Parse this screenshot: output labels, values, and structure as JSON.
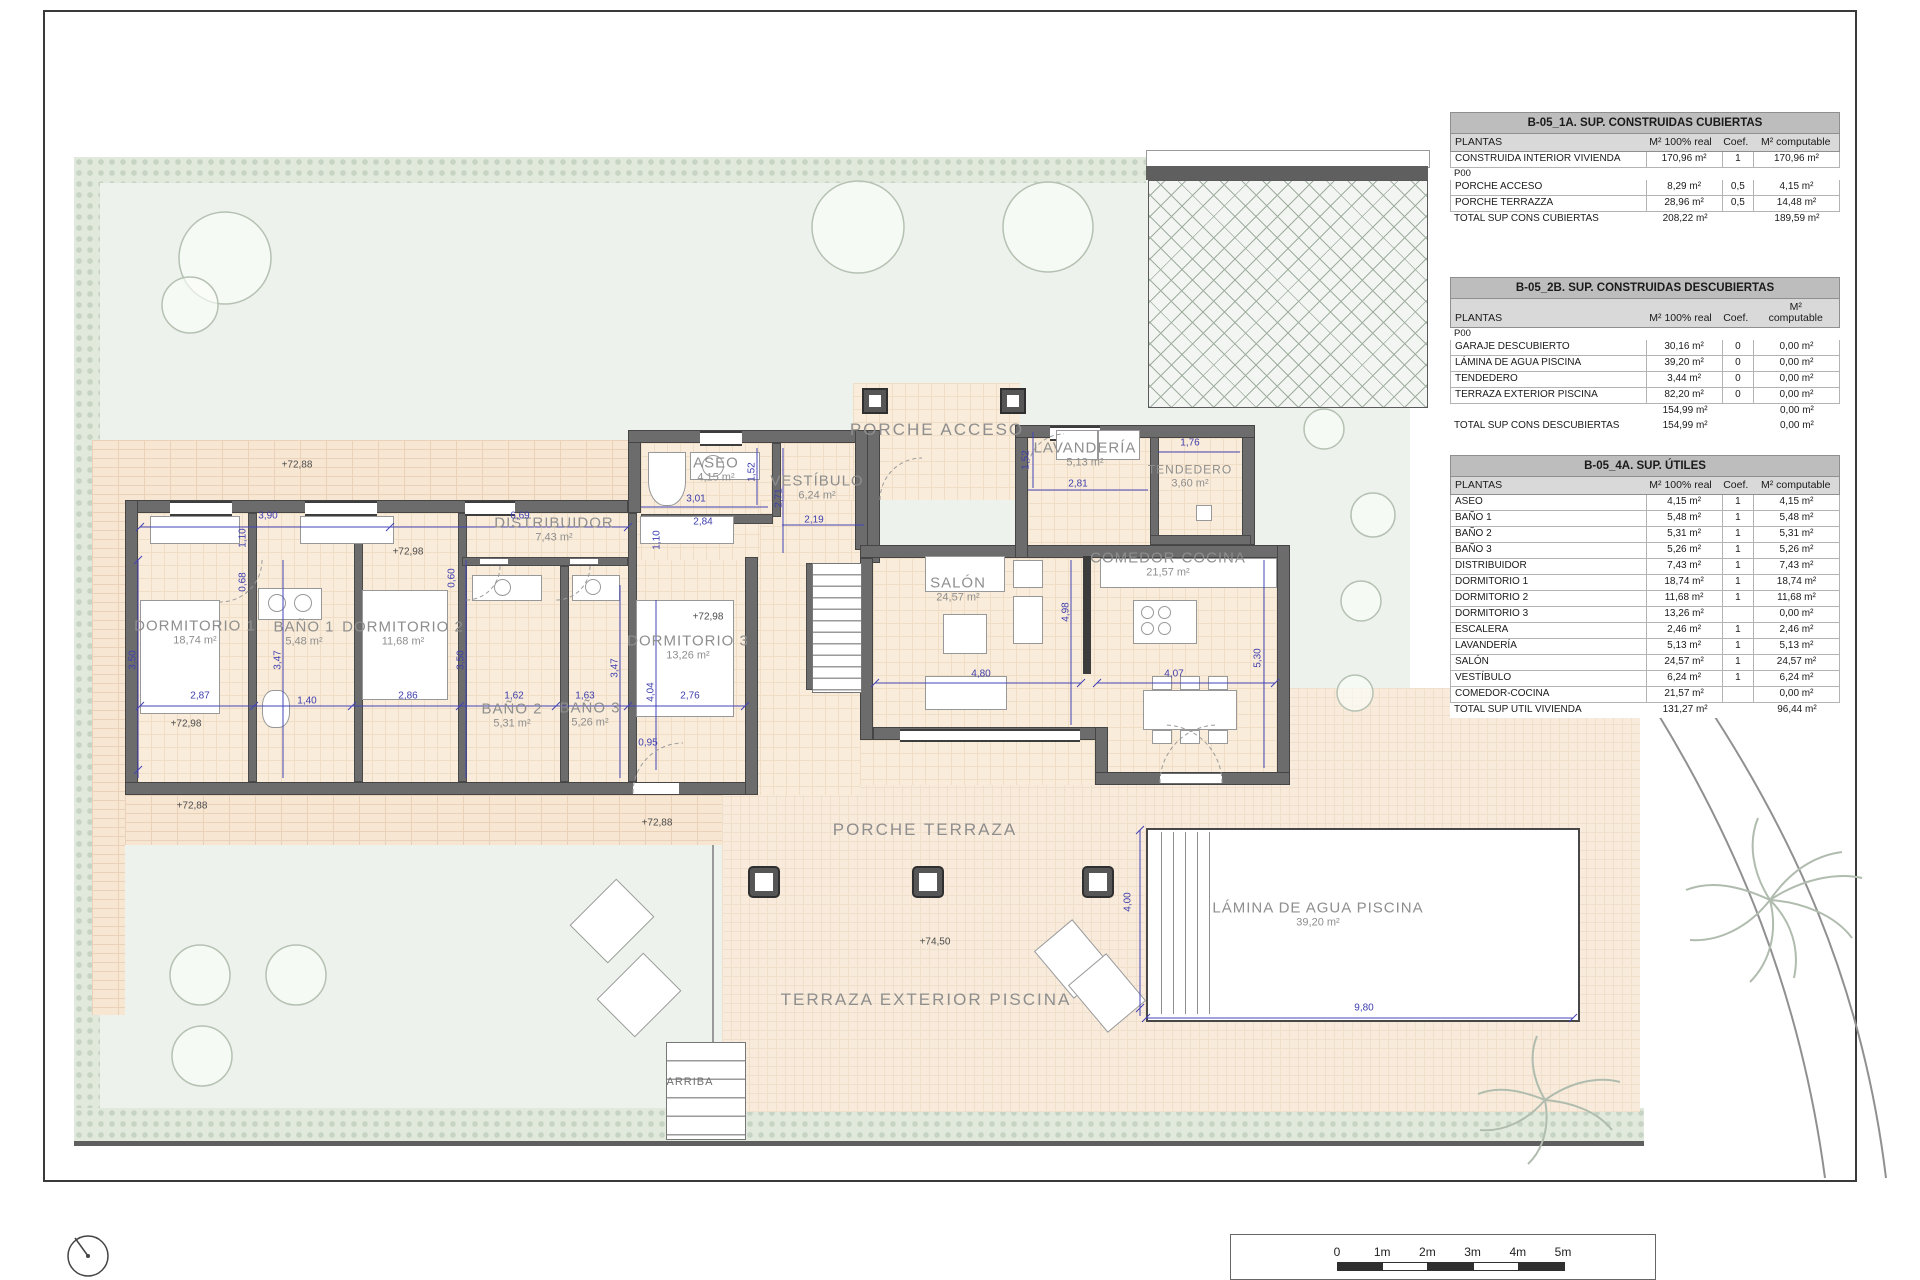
{
  "plan": {
    "rooms": [
      {
        "name": "DORMITORIO 1",
        "area": "18,74 m²",
        "x": 195,
        "y": 633
      },
      {
        "name": "BAÑO 1",
        "area": "5,48 m²",
        "x": 304,
        "y": 634
      },
      {
        "name": "DORMITORIO 2",
        "area": "11,68 m²",
        "x": 403,
        "y": 634
      },
      {
        "name": "BAÑO 2",
        "area": "5,31 m²",
        "x": 512,
        "y": 716
      },
      {
        "name": "BAÑO 3",
        "area": "5,26 m²",
        "x": 590,
        "y": 715
      },
      {
        "name": "DORMITORIO 3",
        "area": "13,26 m²",
        "x": 688,
        "y": 648
      },
      {
        "name": "DISTRIBUIDOR",
        "area": "7,43 m²",
        "x": 554,
        "y": 530
      },
      {
        "name": "ASEO",
        "area": "4,15 m²",
        "x": 716,
        "y": 470
      },
      {
        "name": "VESTÍBULO",
        "area": "6,24 m²",
        "x": 817,
        "y": 488
      },
      {
        "name": "SALÓN",
        "area": "24,57 m²",
        "x": 958,
        "y": 590
      },
      {
        "name": "COMEDOR-COCINA",
        "area": "21,57 m²",
        "x": 1168,
        "y": 565
      },
      {
        "name": "LAVANDERÍA",
        "area": "5,13 m²",
        "x": 1085,
        "y": 455
      },
      {
        "name": "TENDEDERO",
        "area": "3,60 m²",
        "x": 1190,
        "y": 476,
        "size": "sm2"
      },
      {
        "name": "PORCHE ACCESO",
        "area": "",
        "x": 937,
        "y": 430,
        "size": "big"
      },
      {
        "name": "PORCHE TERRAZA",
        "area": "",
        "x": 925,
        "y": 830,
        "size": "big"
      },
      {
        "name": "TERRAZA EXTERIOR PISCINA",
        "area": "",
        "x": 926,
        "y": 1000,
        "size": "big"
      },
      {
        "name": "LÁMINA DE AGUA PISCINA",
        "area": "39,20 m²",
        "x": 1318,
        "y": 915
      },
      {
        "name": "ARRIBA",
        "area": "",
        "x": 690,
        "y": 1082,
        "size": "sm"
      }
    ],
    "dimensions": [
      {
        "t": "2,87",
        "x": 200,
        "y": 696
      },
      {
        "t": "1,40",
        "x": 307,
        "y": 701
      },
      {
        "t": "2,86",
        "x": 408,
        "y": 696
      },
      {
        "t": "1,62",
        "x": 514,
        "y": 696
      },
      {
        "t": "1,63",
        "x": 585,
        "y": 696
      },
      {
        "t": "2,76",
        "x": 690,
        "y": 696
      },
      {
        "t": "3,50",
        "x": 133,
        "y": 660,
        "rot": true
      },
      {
        "t": "3,47",
        "x": 278,
        "y": 660,
        "rot": true
      },
      {
        "t": "3,50",
        "x": 461,
        "y": 660,
        "rot": true
      },
      {
        "t": "3,47",
        "x": 615,
        "y": 668,
        "rot": true
      },
      {
        "t": "4,04",
        "x": 651,
        "y": 692,
        "rot": true
      },
      {
        "t": "3,90",
        "x": 268,
        "y": 516
      },
      {
        "t": "6,69",
        "x": 520,
        "y": 516
      },
      {
        "t": "1,10",
        "x": 243,
        "y": 538,
        "rot": true
      },
      {
        "t": "0,68",
        "x": 243,
        "y": 582,
        "rot": true
      },
      {
        "t": "0,60",
        "x": 452,
        "y": 578,
        "rot": true
      },
      {
        "t": "0,95",
        "x": 648,
        "y": 743
      },
      {
        "t": "1,10",
        "x": 657,
        "y": 540,
        "rot": true
      },
      {
        "t": "2,84",
        "x": 703,
        "y": 522
      },
      {
        "t": "3,01",
        "x": 696,
        "y": 499
      },
      {
        "t": "1,52",
        "x": 752,
        "y": 472,
        "rot": true
      },
      {
        "t": "2,19",
        "x": 814,
        "y": 520
      },
      {
        "t": "2,71",
        "x": 779,
        "y": 498,
        "rot": true
      },
      {
        "t": "2,81",
        "x": 1078,
        "y": 484
      },
      {
        "t": "1,52",
        "x": 1026,
        "y": 460,
        "rot": true
      },
      {
        "t": "1,76",
        "x": 1190,
        "y": 443
      },
      {
        "t": "4,80",
        "x": 981,
        "y": 674
      },
      {
        "t": "4,98",
        "x": 1066,
        "y": 612,
        "rot": true
      },
      {
        "t": "4,07",
        "x": 1174,
        "y": 674
      },
      {
        "t": "5,30",
        "x": 1258,
        "y": 658,
        "rot": true
      },
      {
        "t": "9,80",
        "x": 1364,
        "y": 1008
      },
      {
        "t": "4,00",
        "x": 1128,
        "y": 902,
        "rot": true
      }
    ],
    "levels": [
      {
        "t": "+72,88",
        "x": 297,
        "y": 465
      },
      {
        "t": "+72,98",
        "x": 408,
        "y": 552
      },
      {
        "t": "+72,98",
        "x": 186,
        "y": 724
      },
      {
        "t": "+72,88",
        "x": 192,
        "y": 806
      },
      {
        "t": "+72,88",
        "x": 657,
        "y": 823
      },
      {
        "t": "+72,98",
        "x": 708,
        "y": 617
      },
      {
        "t": "+74,50",
        "x": 935,
        "y": 942
      }
    ]
  },
  "tables": [
    {
      "title": "B-05_1A. SUP. CONSTRUIDAS CUBIERTAS",
      "headers": [
        "PLANTAS",
        "M² 100% real",
        "Coef.",
        "M² computable"
      ],
      "rows": [
        {
          "kind": "data",
          "cells": [
            "CONSTRUIDA INTERIOR VIVIENDA",
            "170,96 m²",
            "1",
            "170,96 m²"
          ]
        },
        {
          "kind": "section",
          "cells": [
            "P00",
            "",
            "",
            ""
          ]
        },
        {
          "kind": "data",
          "cells": [
            "PORCHE ACCESO",
            "8,29 m²",
            "0,5",
            "4,15 m²"
          ]
        },
        {
          "kind": "data",
          "cells": [
            "PORCHE TERRAZZA",
            "28,96 m²",
            "0,5",
            "14,48 m²"
          ]
        },
        {
          "kind": "total",
          "cells": [
            "TOTAL SUP CONS CUBIERTAS",
            "208,22 m²",
            "",
            "189,59 m²"
          ]
        }
      ]
    },
    {
      "title": "B-05_2B. SUP. CONSTRUIDAS DESCUBIERTAS",
      "headers": [
        "PLANTAS",
        "M² 100% real",
        "Coef.",
        "M²\ncomputable"
      ],
      "rows": [
        {
          "kind": "section",
          "cells": [
            "P00",
            "",
            "",
            ""
          ]
        },
        {
          "kind": "data",
          "cells": [
            "GARAJE DESCUBIERTO",
            "30,16 m²",
            "0",
            "0,00 m²"
          ]
        },
        {
          "kind": "data",
          "cells": [
            "LÁMINA DE AGUA PISCINA",
            "39,20 m²",
            "0",
            "0,00 m²"
          ]
        },
        {
          "kind": "data",
          "cells": [
            "TENDEDERO",
            "3,44 m²",
            "0",
            "0,00 m²"
          ]
        },
        {
          "kind": "data",
          "cells": [
            "TERRAZA EXTERIOR PISCINA",
            "82,20 m²",
            "0",
            "0,00 m²"
          ]
        },
        {
          "kind": "total",
          "cells": [
            "",
            "154,99 m²",
            "",
            "0,00 m²"
          ]
        },
        {
          "kind": "total",
          "cells": [
            "TOTAL SUP CONS DESCUBIERTAS",
            "154,99 m²",
            "",
            "0,00 m²"
          ]
        }
      ]
    },
    {
      "title": "B-05_4A. SUP. ÚTILES",
      "headers": [
        "PLANTAS",
        "M² 100% real",
        "Coef.",
        "M² computable"
      ],
      "rows": [
        {
          "kind": "data",
          "cells": [
            "ASEO",
            "4,15 m²",
            "1",
            "4,15 m²"
          ]
        },
        {
          "kind": "data",
          "cells": [
            "BAÑO 1",
            "5,48 m²",
            "1",
            "5,48 m²"
          ]
        },
        {
          "kind": "data",
          "cells": [
            "BAÑO 2",
            "5,31 m²",
            "1",
            "5,31 m²"
          ]
        },
        {
          "kind": "data",
          "cells": [
            "BAÑO 3",
            "5,26 m²",
            "1",
            "5,26 m²"
          ]
        },
        {
          "kind": "data",
          "cells": [
            "DISTRIBUIDOR",
            "7,43 m²",
            "1",
            "7,43 m²"
          ]
        },
        {
          "kind": "data",
          "cells": [
            "DORMITORIO 1",
            "18,74 m²",
            "1",
            "18,74 m²"
          ]
        },
        {
          "kind": "data",
          "cells": [
            "DORMITORIO 2",
            "11,68 m²",
            "1",
            "11,68 m²"
          ]
        },
        {
          "kind": "data",
          "cells": [
            "DORMITORIO 3",
            "13,26 m²",
            "",
            "0,00 m²"
          ]
        },
        {
          "kind": "data",
          "cells": [
            "ESCALERA",
            "2,46 m²",
            "1",
            "2,46 m²"
          ]
        },
        {
          "kind": "data",
          "cells": [
            "LAVANDERÍA",
            "5,13 m²",
            "1",
            "5,13 m²"
          ]
        },
        {
          "kind": "data",
          "cells": [
            "SALÓN",
            "24,57 m²",
            "1",
            "24,57 m²"
          ]
        },
        {
          "kind": "data",
          "cells": [
            "VESTÍBULO",
            "6,24 m²",
            "1",
            "6,24 m²"
          ]
        },
        {
          "kind": "data",
          "cells": [
            "COMEDOR-COCINA",
            "21,57 m²",
            "",
            "0,00 m²"
          ]
        },
        {
          "kind": "total",
          "cells": [
            "TOTAL SUP UTIL VIVIENDA",
            "131,27 m²",
            "",
            "96,44 m²"
          ]
        }
      ]
    }
  ],
  "scalebar": {
    "labels": [
      "0",
      "1m",
      "2m",
      "3m",
      "4m",
      "5m"
    ]
  }
}
